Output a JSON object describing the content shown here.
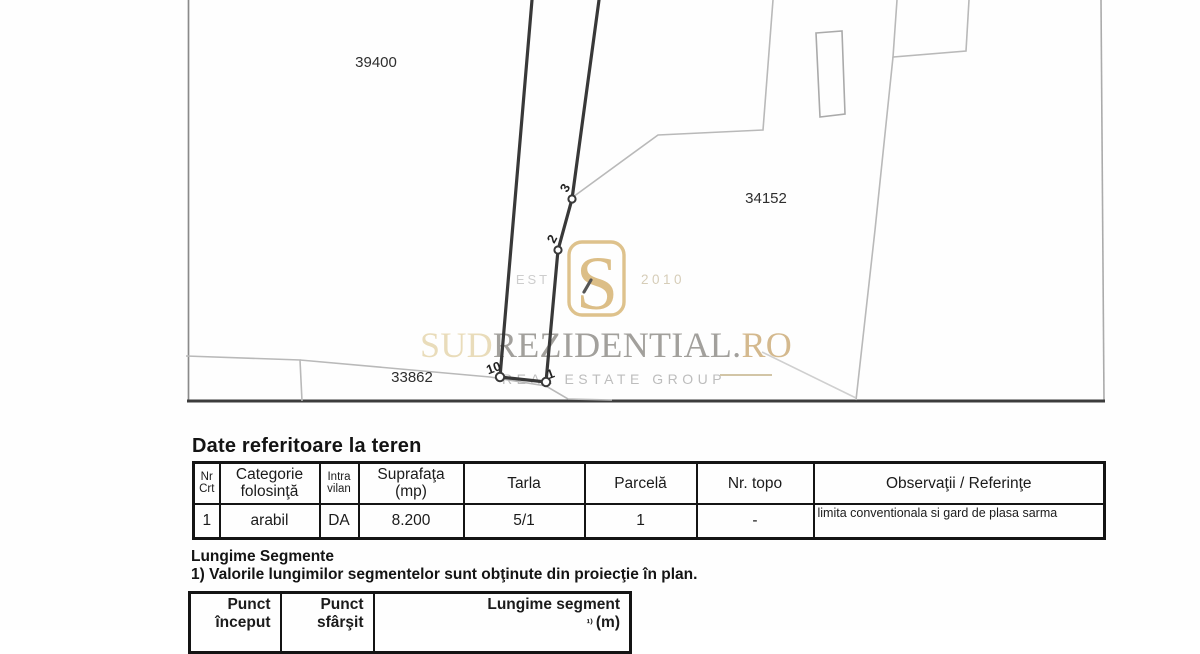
{
  "map": {
    "parcel_labels": [
      {
        "text": "39400"
      },
      {
        "text": "34152"
      },
      {
        "text": "33862"
      }
    ],
    "point_labels": [
      "3",
      "2",
      "10",
      "1"
    ],
    "colors": {
      "subject_line": "#383838",
      "neighbor_line": "#b9b9b9",
      "border_dark": "#3c3c3c"
    }
  },
  "logo": {
    "est": "EST",
    "year": "2010",
    "sud": "SUD",
    "rezidential": "REZIDENTIAL",
    "dot": ".",
    "ro": "RO",
    "tagline": "REAL ESTATE GROUP",
    "colors": {
      "gold": "#d3ad66",
      "light_gold": "#e9dcba",
      "gray": "#a2a09c"
    }
  },
  "section_teren": {
    "title": "Date referitoare la teren",
    "table": {
      "headers": [
        {
          "l1": "Nr",
          "l2": "Crt",
          "small": true
        },
        {
          "l1": "Categorie",
          "l2": "folosinţă",
          "small": false
        },
        {
          "l1": "Intra",
          "l2": "vilan",
          "small": true
        },
        {
          "l1": "Suprafaţa",
          "l2": "(mp)",
          "small": false
        },
        {
          "l1": "Tarla",
          "l2": "",
          "small": false
        },
        {
          "l1": "Parcelă",
          "l2": "",
          "small": false
        },
        {
          "l1": "Nr. topo",
          "l2": "",
          "small": false
        },
        {
          "l1": "Observaţii / Referinţe",
          "l2": "",
          "small": false
        }
      ],
      "row": {
        "nr": "1",
        "categorie": "arabil",
        "intravilan": "DA",
        "suprafata": "8.200",
        "tarla": "5/1",
        "parcela": "1",
        "nr_topo": "-",
        "observatii": "limita conventionala si gard de plasa sarma"
      }
    }
  },
  "section_segmente": {
    "title": "Lungime Segmente",
    "note": "1) Valorile lungimilor segmentelor sunt obţinute din proiecţie în plan.",
    "table": {
      "headers": [
        {
          "l1": "Punct",
          "l2": "început"
        },
        {
          "l1": "Punct",
          "l2": "sfârşit"
        },
        {
          "l1": "Lungime segment",
          "l2": "(m)",
          "l2_sup": "¹⁾ "
        }
      ]
    }
  }
}
